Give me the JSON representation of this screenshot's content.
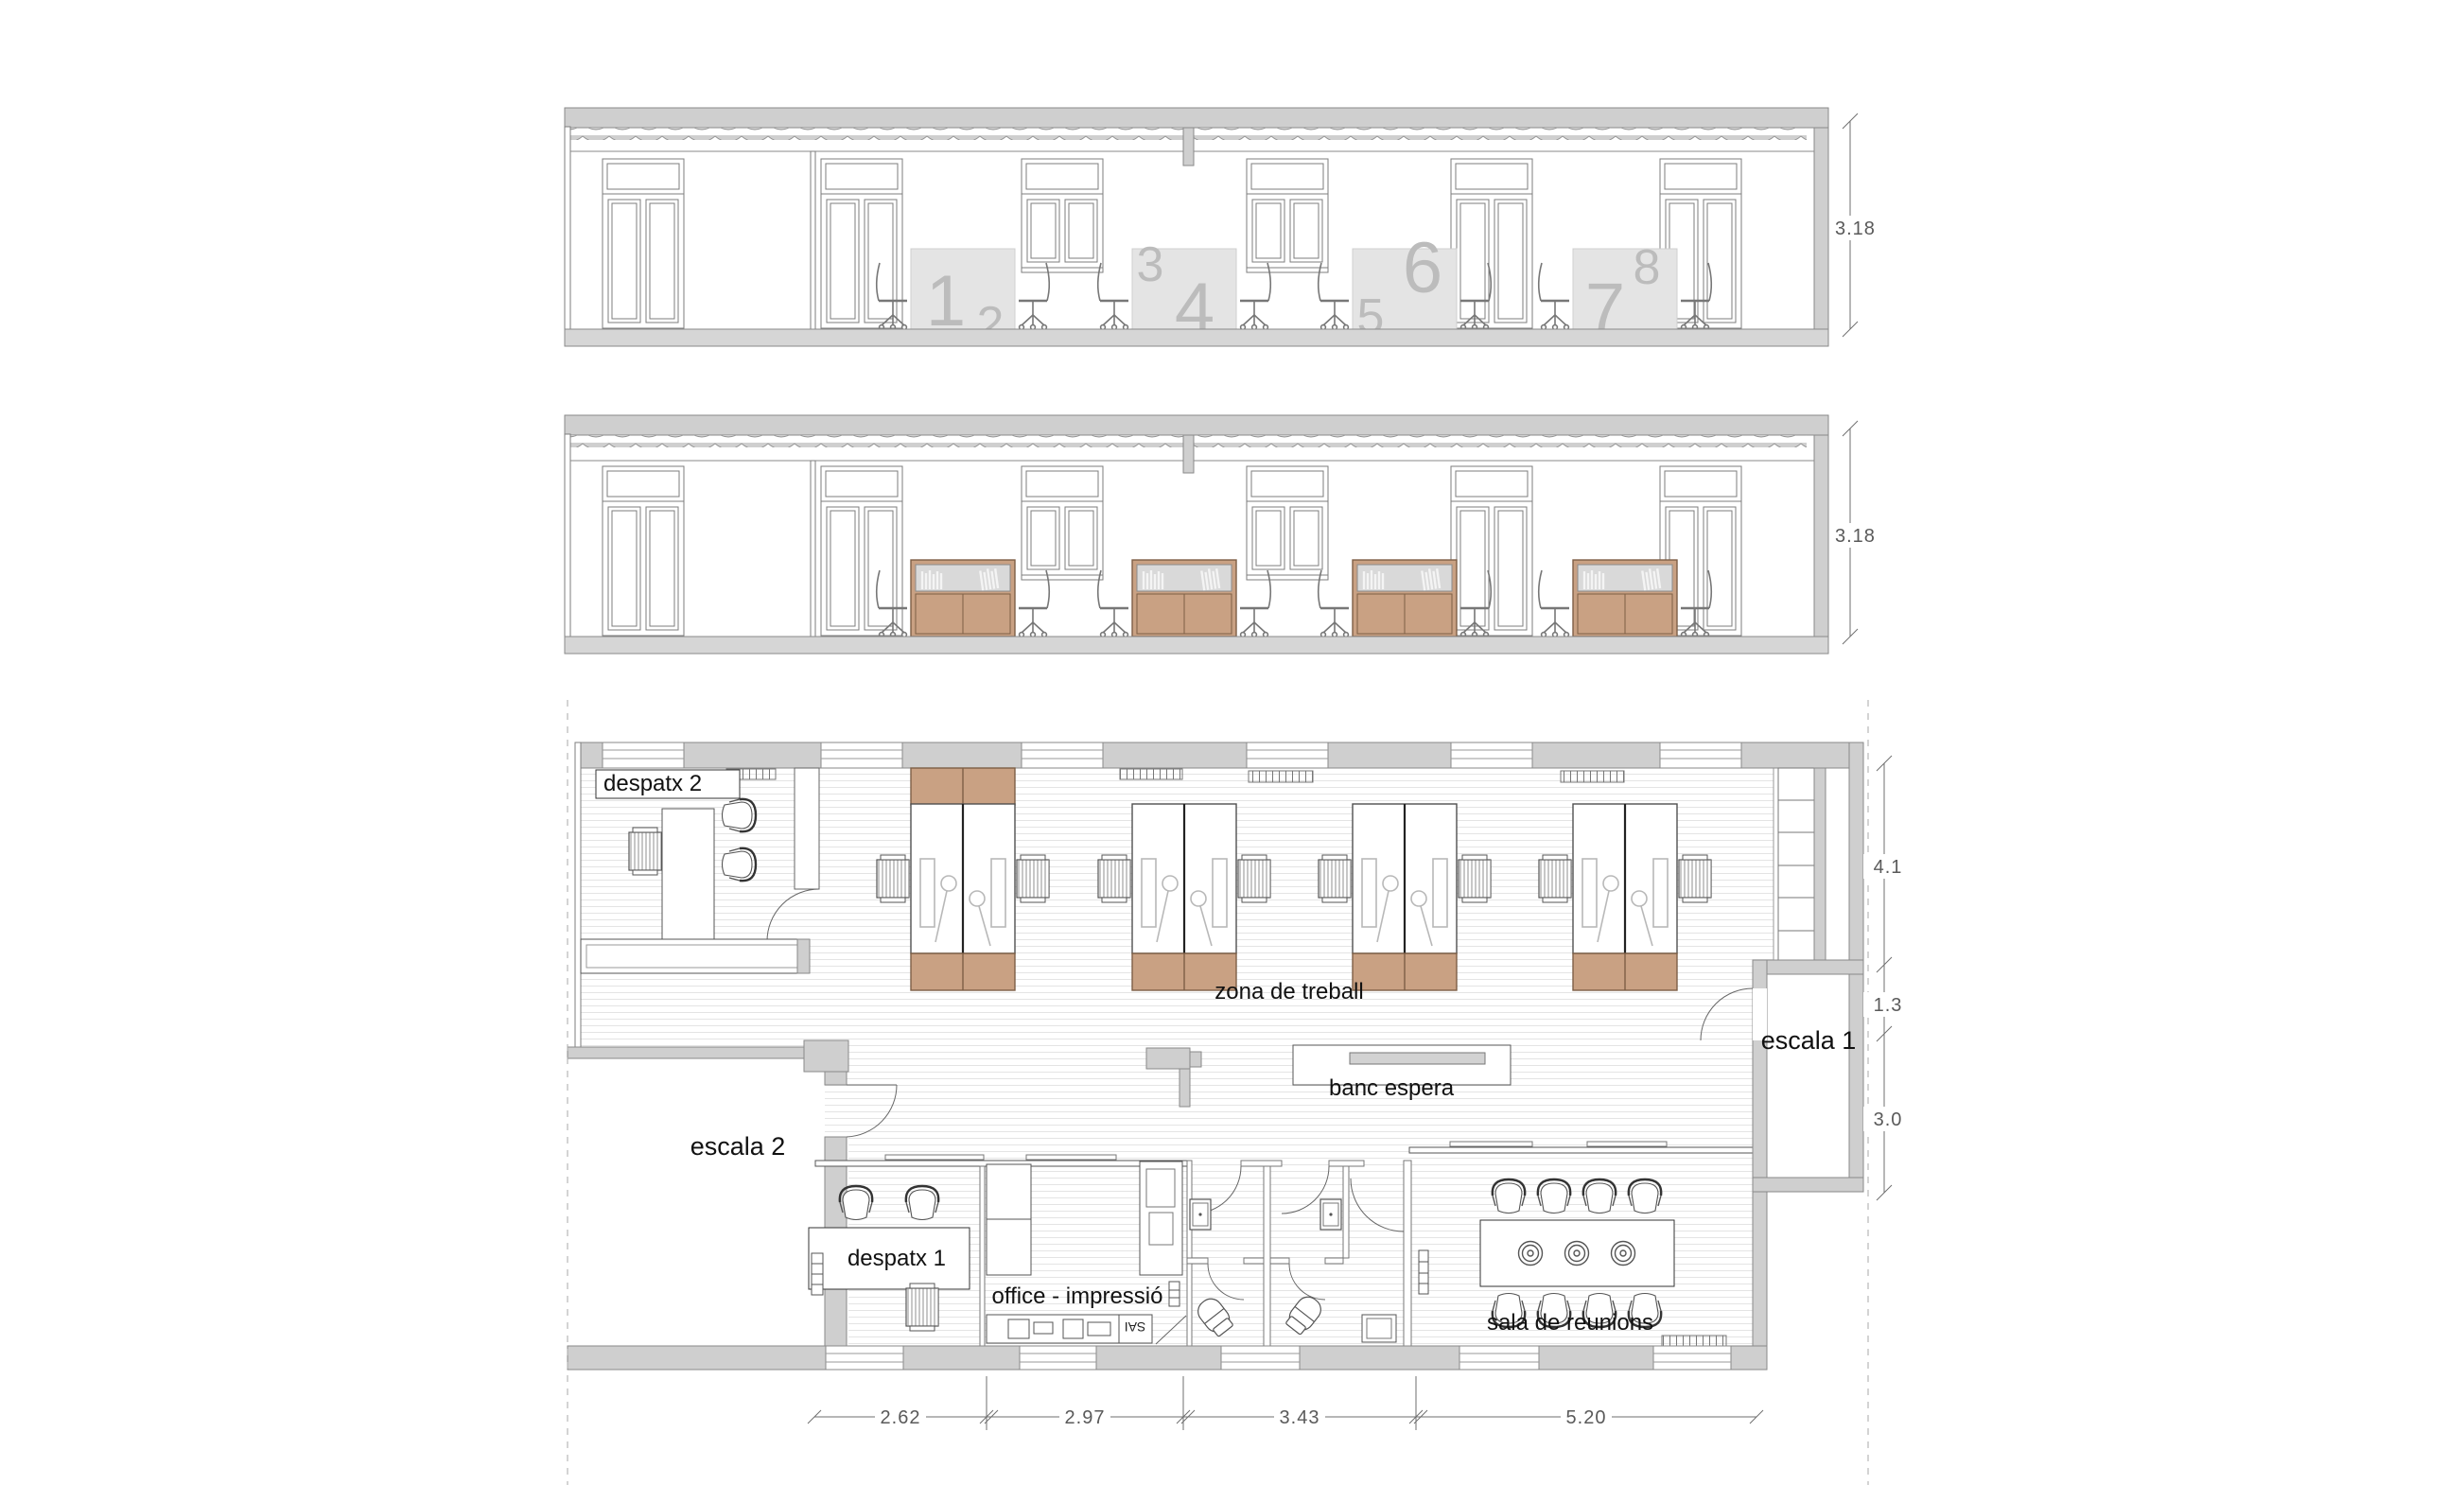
{
  "drawing": {
    "sections": {
      "a": {
        "height_dim": "3.18",
        "desk_numbers": [
          "1",
          "2",
          "3",
          "4",
          "5",
          "6",
          "7",
          "8"
        ]
      },
      "b": {
        "height_dim": "3.18"
      }
    },
    "plan": {
      "labels": {
        "despatx2": "despatx 2",
        "zona": "zona de treball",
        "banc": "banc espera",
        "escala2": "escala 2",
        "escala1": "escala 1",
        "despatx1": "despatx 1",
        "office": "office - impressió",
        "sala": "sala de reunions",
        "sai": "SAI"
      },
      "dims_right": [
        "4.1",
        "1.3",
        "3.0"
      ],
      "dims_bottom": [
        "2.62",
        "2.97",
        "3.43",
        "5.20"
      ]
    },
    "colors": {
      "wall_gray": "#cfcfcf",
      "wood_tan": "#c9a183",
      "desk_panel": "#e4e4e4",
      "panel_number": "#bcbcbc",
      "glass_gray": "#d9d9d9",
      "floor_hatch": "#e4e4e4",
      "linework": "#6f6f6f"
    }
  }
}
